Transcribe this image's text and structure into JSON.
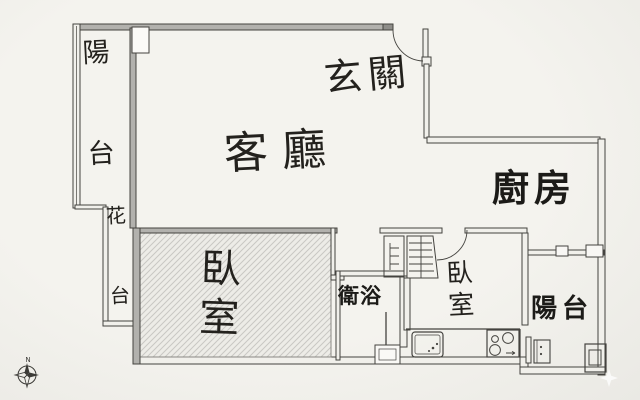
{
  "title": "apartment floor plan",
  "colors": {
    "paper": "#f1f0eb",
    "line": "#44433f",
    "wall_fill": "#b2b1ad",
    "hatch_line": "#c9c8c3",
    "ink": "#23211d"
  },
  "rooms": [
    {
      "name": "balcony-top-left",
      "label": "陽台",
      "style": "handwritten-vertical"
    },
    {
      "name": "entrance",
      "label": "玄關",
      "style": "handwritten"
    },
    {
      "name": "living-room",
      "label": "客廳",
      "style": "handwritten"
    },
    {
      "name": "kitchen",
      "label": "廚房",
      "style": "printed-bold"
    },
    {
      "name": "flower-bed",
      "label": "花台",
      "style": "handwritten-vertical"
    },
    {
      "name": "bedroom-main",
      "label": "臥室",
      "style": "handwritten-vertical",
      "floor": "hatched"
    },
    {
      "name": "bathroom",
      "label": "衛浴",
      "style": "printed"
    },
    {
      "name": "bedroom-second",
      "label": "臥室",
      "style": "handwritten-vertical"
    },
    {
      "name": "balcony-bottom-right",
      "label": "陽台",
      "style": "printed-bold"
    }
  ],
  "compass": {
    "north_label": "N",
    "position": "bottom-left"
  },
  "fixtures": [
    "entry-door-swing",
    "bedroom2-door-swing",
    "closet",
    "wardrobe",
    "kitchen-sink",
    "stove-4-burner",
    "water-heater",
    "floor-drain-box",
    "shower-step",
    "bathroom-door-line",
    "window-wall-segments"
  ]
}
